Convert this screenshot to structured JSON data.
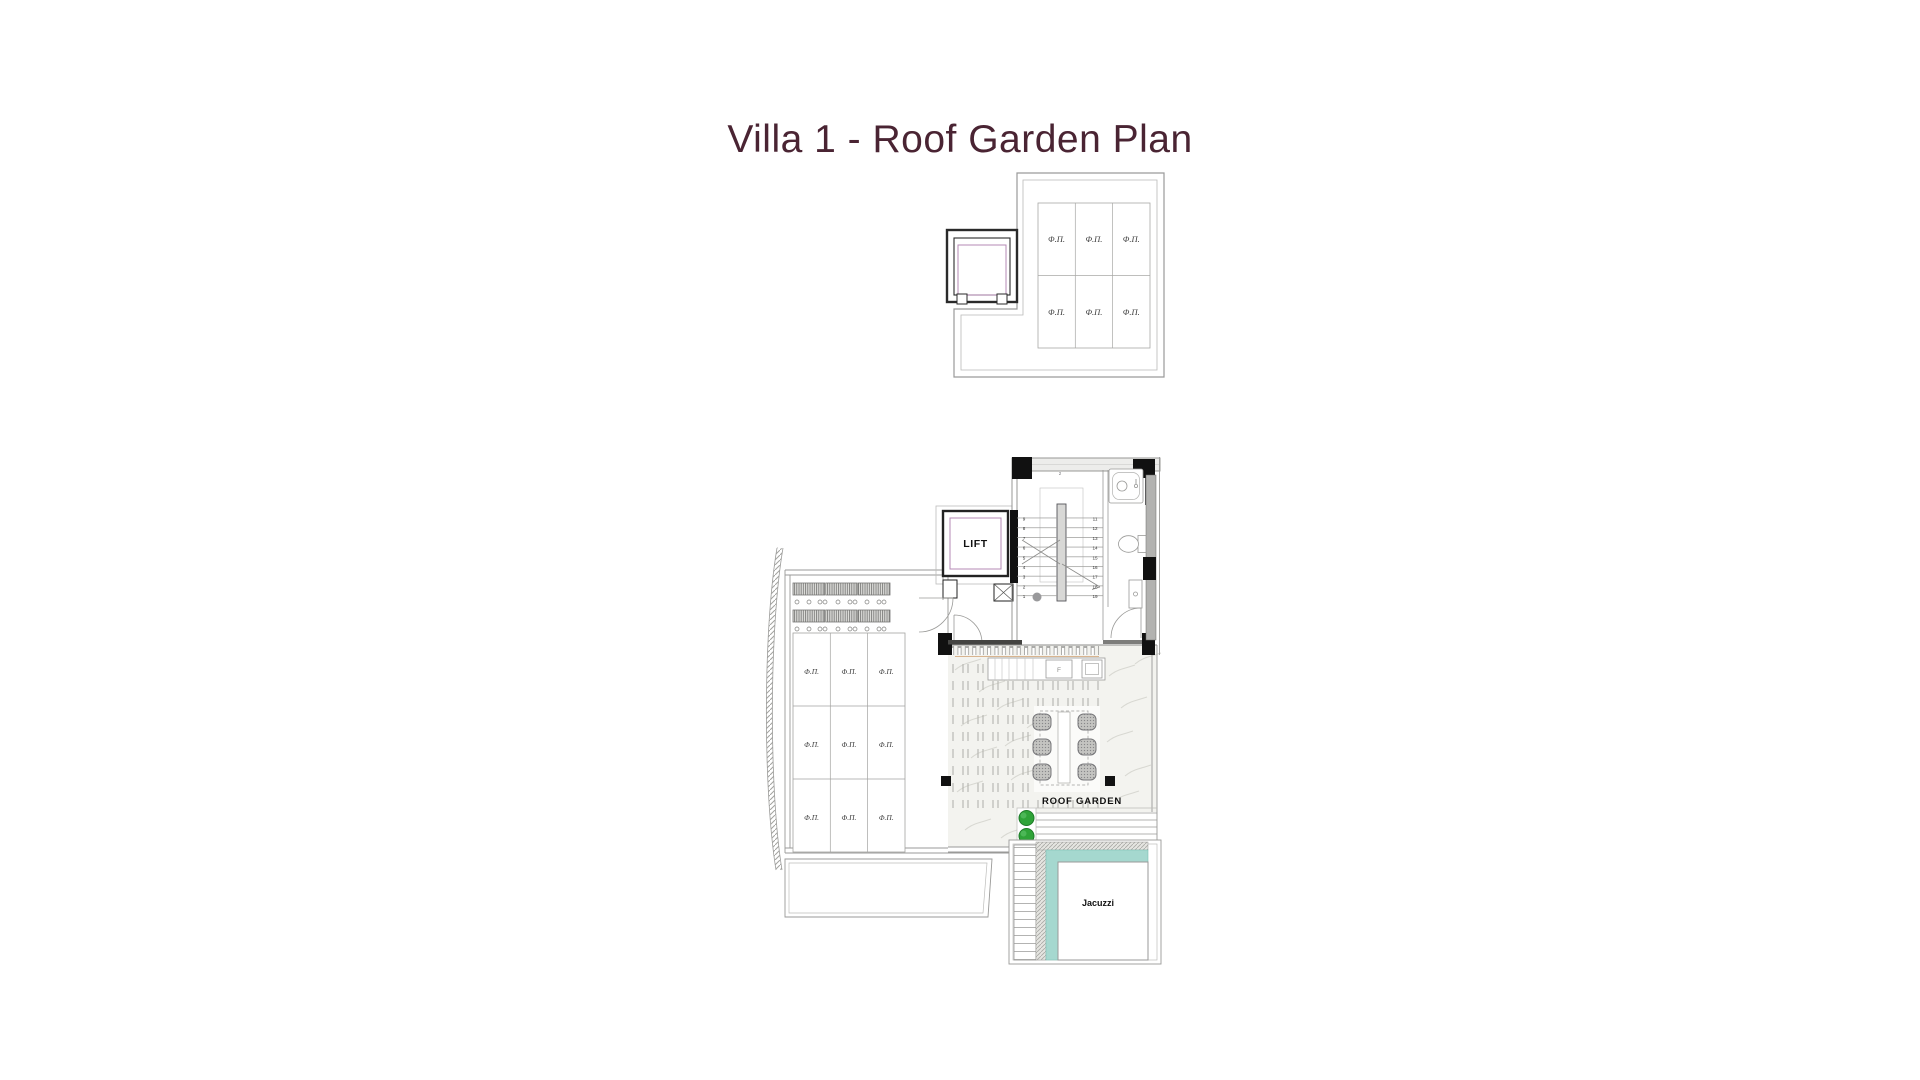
{
  "title": {
    "text": "Villa 1 - Roof Garden Plan",
    "color": "#4a2433"
  },
  "labels": {
    "lift": "LIFT",
    "roof_garden": "ROOF GARDEN",
    "jacuzzi": "Jacuzzi",
    "counter_f": "F",
    "stair_top_marker": "2"
  },
  "solar_panels": {
    "upper_cells": [
      "Φ.Π.",
      "Φ.Π.",
      "Φ.Π.",
      "Φ.Π.",
      "Φ.Π.",
      "Φ.Π."
    ],
    "lower_cells": [
      "Φ.Π.",
      "Φ.Π.",
      "Φ.Π.",
      "Φ.Π.",
      "Φ.Π.",
      "Φ.Π.",
      "Φ.Π.",
      "Φ.Π.",
      "Φ.Π."
    ]
  },
  "stairs": {
    "left_flight": [
      "9",
      "8",
      "7",
      "6",
      "5",
      "4",
      "3",
      "2",
      "1"
    ],
    "right_flight": [
      "11",
      "12",
      "13",
      "14",
      "15",
      "16",
      "17",
      "18",
      "19"
    ]
  },
  "colors": {
    "title_text": "#4a2433",
    "wall_dark": "#111111",
    "line_gray": "#909090",
    "lift_accent": "#b48ab4",
    "jacuzzi_water": "#a5d8cf",
    "tree_green": "#2fa338",
    "marble_floor": "#f3f3ef",
    "planter_gray": "#c4c4c1"
  }
}
